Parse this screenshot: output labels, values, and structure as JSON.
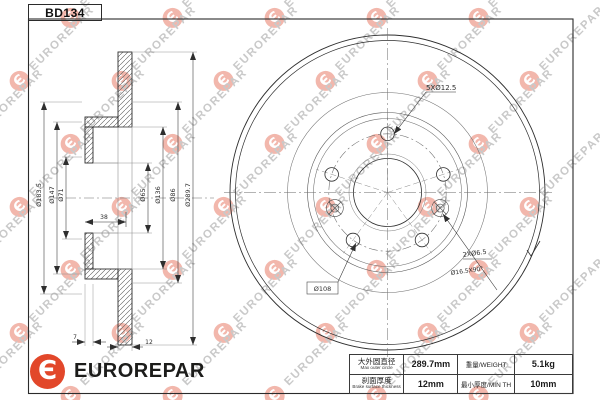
{
  "title_box": {
    "part_number": "BD134"
  },
  "brand": {
    "name": "EUROREPAR",
    "logo_glyph": "Є",
    "logo_color": "#e2472a",
    "text_color": "#1c1c1a"
  },
  "watermark": {
    "text": "EUROREPAR",
    "logo_glyph": "Є",
    "text_color": "#c9c9c9",
    "logo_color": "#f2b7ac"
  },
  "drawing": {
    "section_dims": {
      "d_hat_flange": "Ø183.5",
      "d_hat": "Ø147",
      "d_bore_chamfer": "Ø71",
      "d_bore": "Ø65",
      "d_inner_ring": "Ø136",
      "d_hub_face": "Ø86",
      "d_outer": "Ø289.7",
      "hat_depth": "38",
      "wall_thickness": "7",
      "disc_thickness": "12"
    },
    "front_dims": {
      "bolt_holes": "5XØ12.5",
      "screw_holes": "2XØ6.5",
      "countersink": "Ø16.5X90°",
      "bolt_circle": "Ø108"
    }
  },
  "spec_table": {
    "row1": {
      "label_cn": "大外圆直径",
      "label_en": "Max outer circle",
      "value": "289.7mm",
      "label2": "重量/WEIGHT",
      "value2": "5.1kg"
    },
    "row2": {
      "label_cn": "刹面厚度",
      "label_en": "Brake surface thickness",
      "value": "12mm",
      "label2": "最小厚度/MIN TH",
      "value2": "10mm"
    }
  }
}
